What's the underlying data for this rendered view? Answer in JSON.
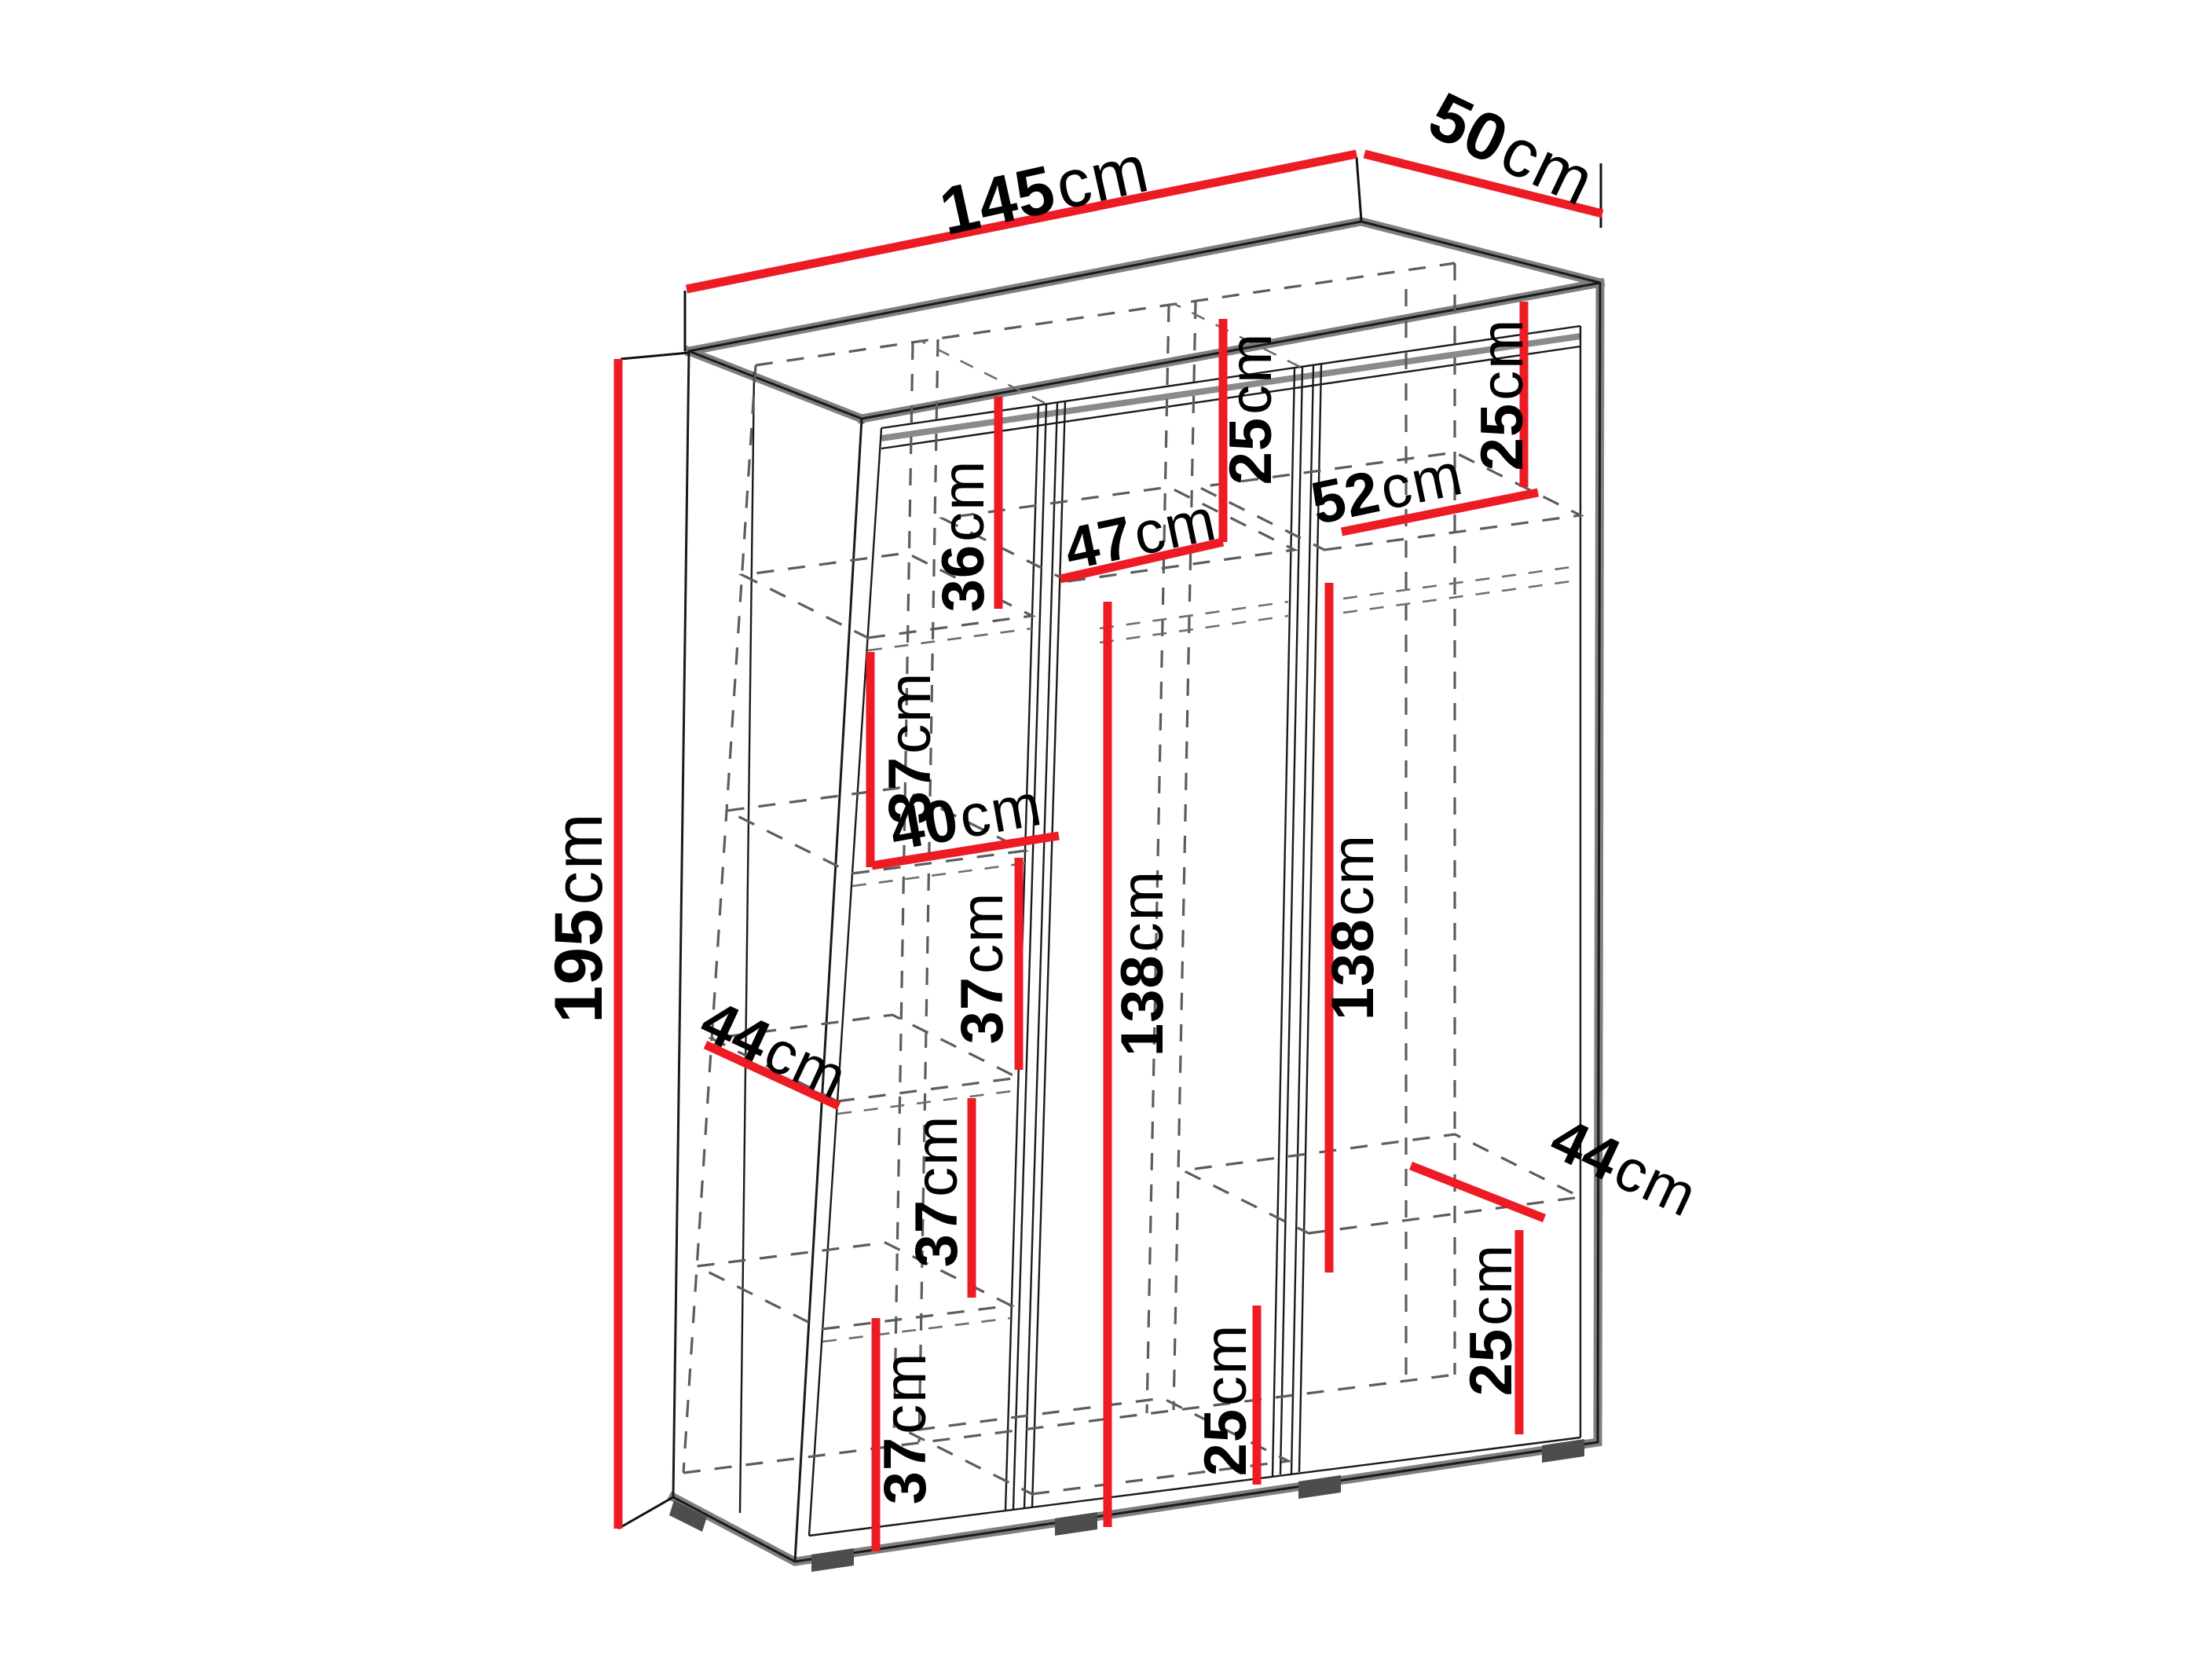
{
  "diagram": {
    "kind": "wardrobe-dimension-diagram",
    "unit": "cm",
    "colors": {
      "dimension_line": "#ed1b24",
      "outline": "#1a1a1a",
      "edge_shadow": "#7f7f7f",
      "hidden_line": "#5c5c5c",
      "background": "#ffffff"
    },
    "overall": {
      "width": {
        "num": "145",
        "unit": "cm"
      },
      "depth": {
        "num": "50",
        "unit": "cm"
      },
      "height": {
        "num": "195",
        "unit": "cm"
      }
    },
    "left_section": {
      "top_gap": {
        "num": "36",
        "unit": "cm"
      },
      "gap_1": {
        "num": "37",
        "unit": "cm"
      },
      "shelf_width": {
        "num": "40",
        "unit": "cm"
      },
      "gap_2": {
        "num": "37",
        "unit": "cm"
      },
      "shelf_depth": {
        "num": "44",
        "unit": "cm"
      },
      "gap_3": {
        "num": "37",
        "unit": "cm"
      },
      "gap_4": {
        "num": "37",
        "unit": "cm"
      }
    },
    "middle_section": {
      "top_gap": {
        "num": "25",
        "unit": "cm"
      },
      "width": {
        "num": "47",
        "unit": "cm"
      },
      "hanging_height": {
        "num": "138",
        "unit": "cm"
      },
      "bottom_gap": {
        "num": "25",
        "unit": "cm"
      }
    },
    "right_section": {
      "top_gap": {
        "num": "25",
        "unit": "cm"
      },
      "width": {
        "num": "52",
        "unit": "cm"
      },
      "hanging_height": {
        "num": "138",
        "unit": "cm"
      },
      "shelf_depth": {
        "num": "44",
        "unit": "cm"
      },
      "bottom_gap": {
        "num": "25",
        "unit": "cm"
      }
    }
  }
}
